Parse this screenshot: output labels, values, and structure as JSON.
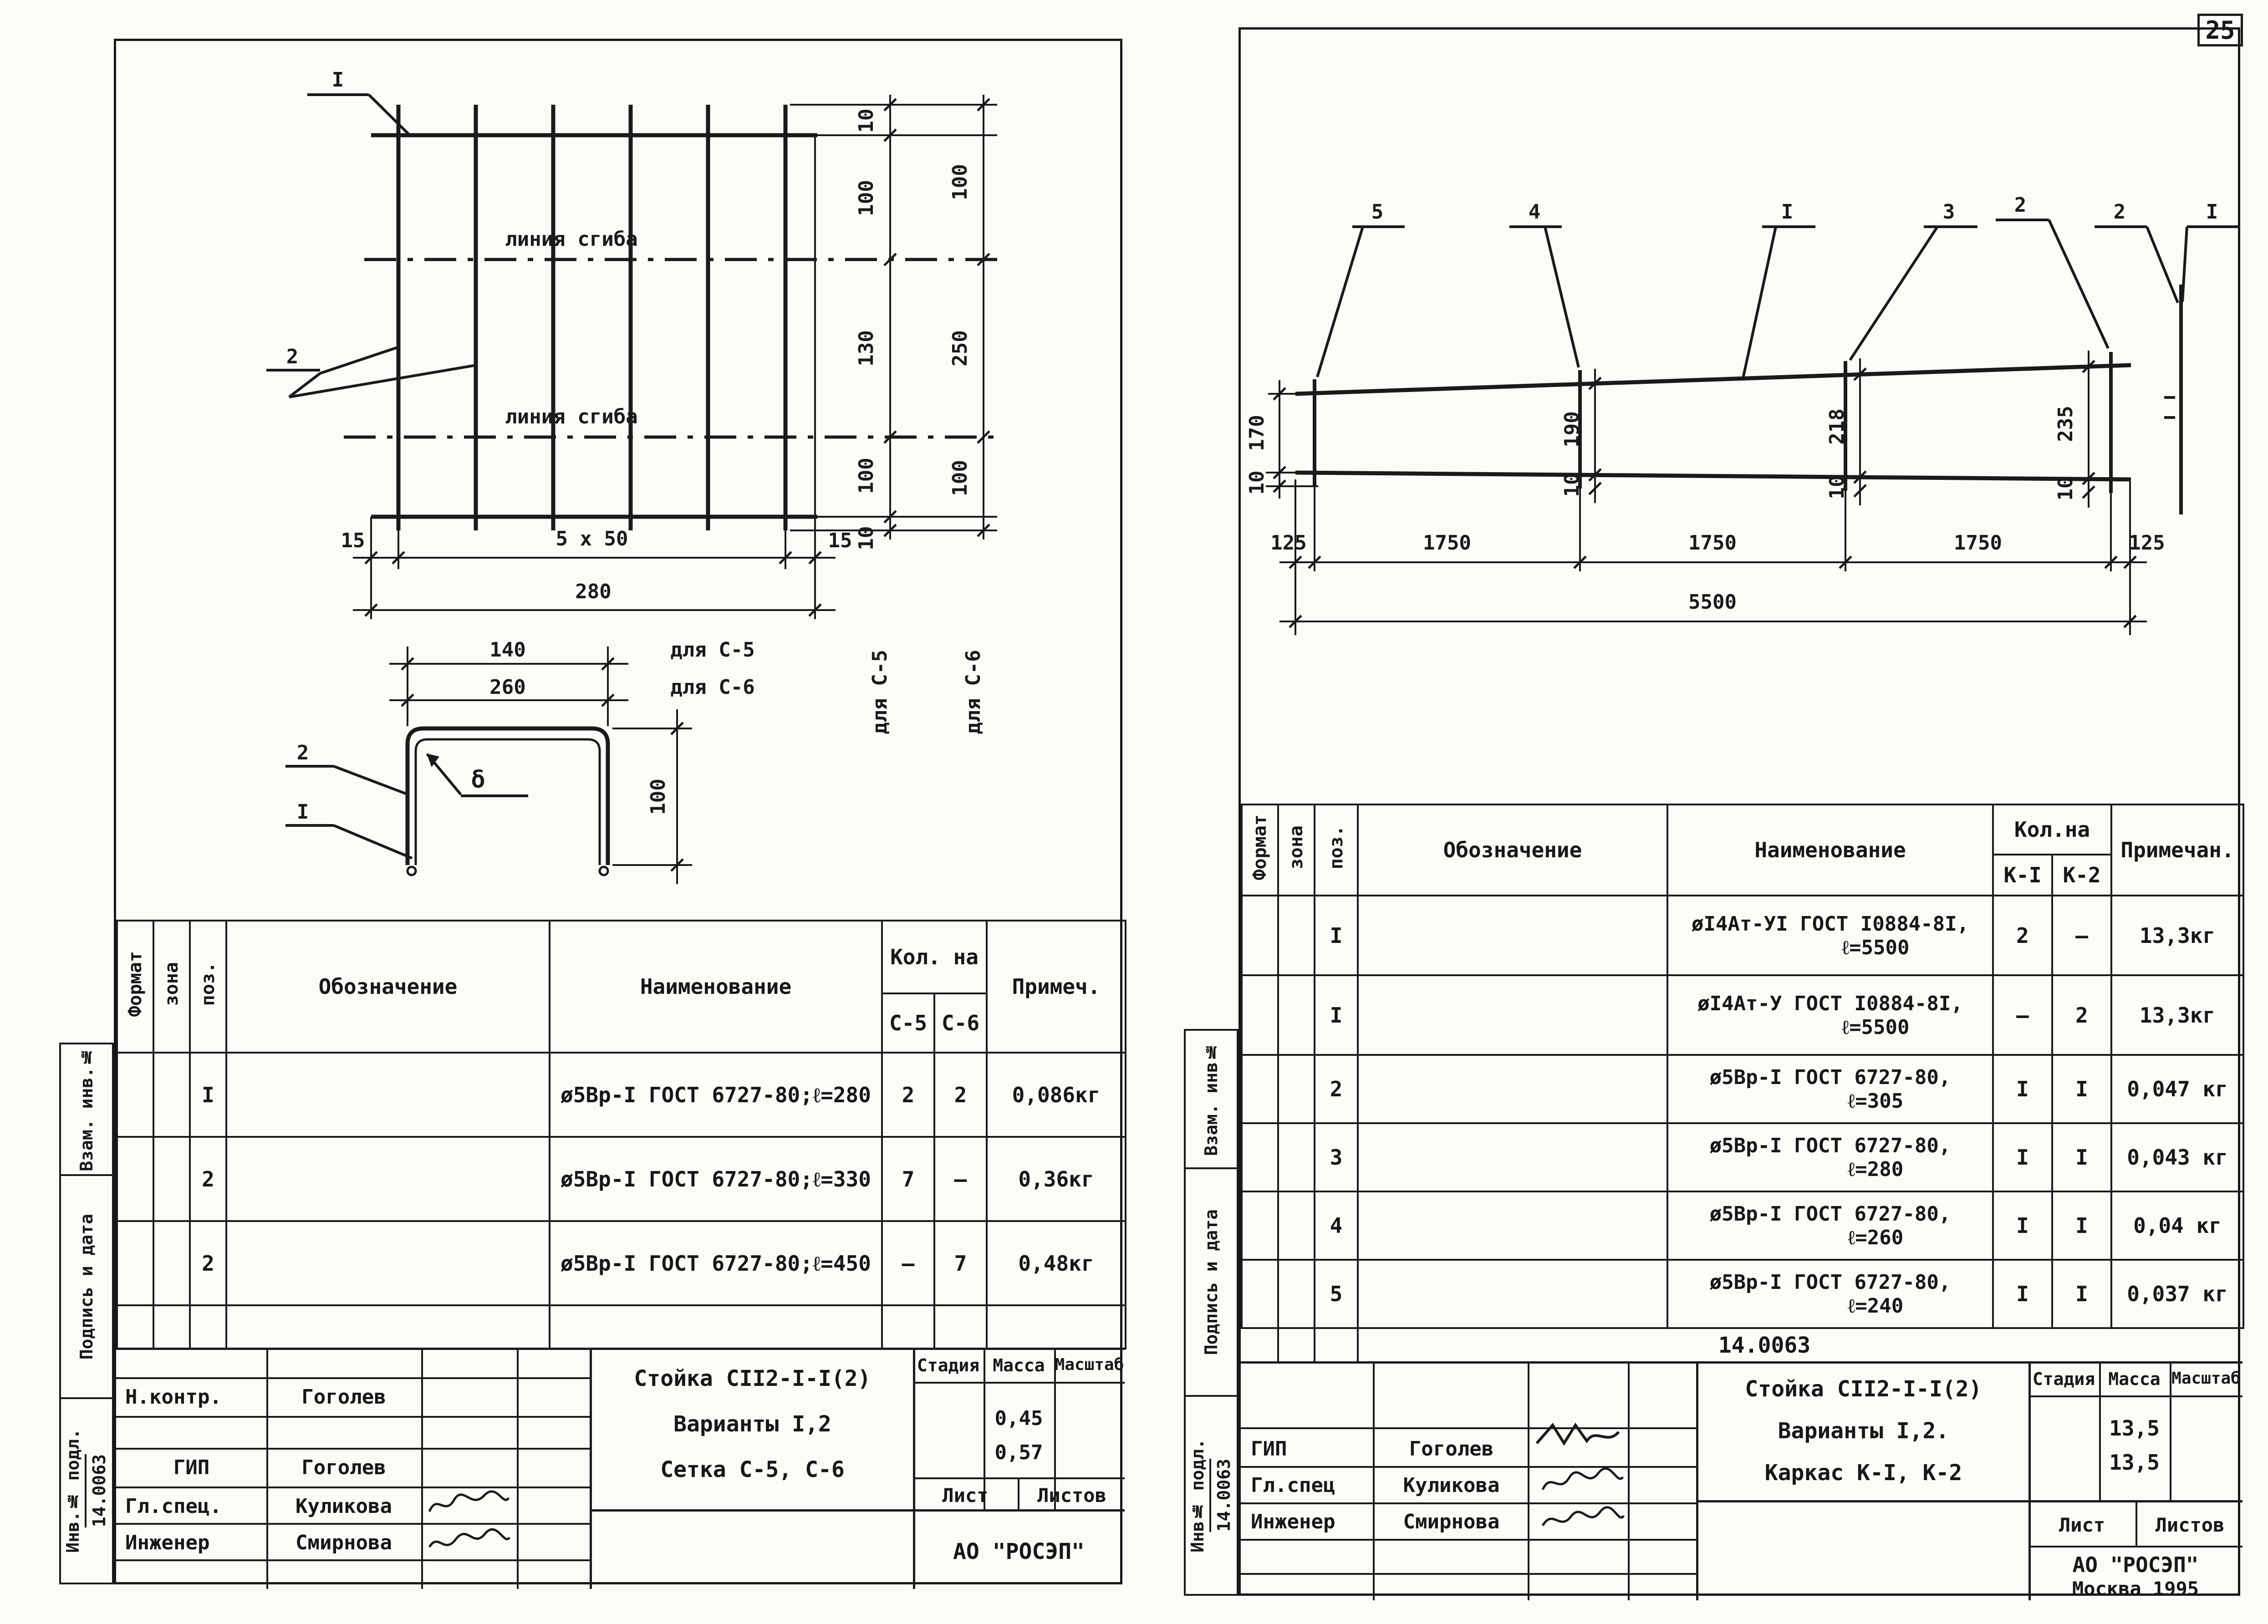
{
  "page_number": "25",
  "left_sheet": {
    "margin": {
      "vzam": "Взам. инв.№",
      "podpis": "Подпись и дата",
      "inv": "Инв.№ подл.",
      "doc": "14.0063"
    },
    "drawing": {
      "callout_1": "I",
      "callout_2": "2",
      "fold_label_1": "линия сгиба",
      "fold_label_2": "линия сгиба",
      "c5_chain": [
        "10",
        "100",
        "130",
        "100",
        "10"
      ],
      "c6_chain": [
        "100",
        "250",
        "100"
      ],
      "for_c5": "для С-5",
      "for_c6": "для С-6",
      "bottom_dims": [
        "15",
        "5 x 50",
        "15"
      ],
      "total_width": "280",
      "profile": {
        "callout_2": "2",
        "callout_1": "I",
        "thickness": "δ",
        "width_c5": "140",
        "width_c5_for": "для С-5",
        "width_c6": "260",
        "width_c6_for": "для С-6",
        "height": "100"
      }
    },
    "table": {
      "format": "Формат",
      "zone": "зона",
      "pos": "поз.",
      "designation": "Обозначение",
      "name": "Наименование",
      "qty": "Кол. на",
      "c5": "С-5",
      "c6": "С-6",
      "note": "Примеч.",
      "rows": [
        {
          "pos": "I",
          "name": "ø5Вр-I ГОСТ 6727-80;ℓ=280",
          "c5": "2",
          "c6": "2",
          "note": "0,086кг"
        },
        {
          "pos": "2",
          "name": "ø5Вр-I ГОСТ 6727-80;ℓ=330",
          "c5": "7",
          "c6": "–",
          "note": "0,36кг"
        },
        {
          "pos": "2",
          "name": "ø5Вр-I ГОСТ 6727-80;ℓ=450",
          "c5": "–",
          "c6": "7",
          "note": "0,48кг"
        }
      ]
    },
    "title_block": {
      "nkontr_role": "Н.контр.",
      "nkontr_name": "Гоголев",
      "gip_role": "ГИП",
      "gip_name": "Гоголев",
      "glspec_role": "Гл.спец.",
      "glspec_name": "Куликова",
      "engineer_role": "Инженер",
      "engineer_name": "Смирнова",
      "title_line1": "Стойка СII2-I-I(2)",
      "title_line2": "Варианты I,2",
      "title_line3": "Сетка С-5, С-6",
      "stage": "Стадия",
      "mass": "Масса",
      "scale": "Масштаб",
      "mass_1": "0,45",
      "mass_2": "0,57",
      "sheet": "Лист",
      "sheets": "Листов",
      "org": "АО \"РОСЭП\""
    }
  },
  "right_sheet": {
    "margin": {
      "vzam": "Взам. инв№",
      "podpis": "Подпись и дата",
      "inv": "Инв№ подл.",
      "doc": "14.0063"
    },
    "doc_number": "14.0063",
    "drawing": {
      "callouts": [
        "5",
        "4",
        "I",
        "3",
        "2"
      ],
      "detail_callouts": [
        "2",
        "I"
      ],
      "left_height": "170",
      "left_offset": "10",
      "mid_dims": [
        {
          "h": "190",
          "p": "10"
        },
        {
          "h": "218",
          "p": "10"
        },
        {
          "h": "235",
          "p": "10"
        }
      ],
      "bottom_dims": [
        "125",
        "1750",
        "1750",
        "1750",
        "125"
      ],
      "total_length": "5500"
    },
    "table": {
      "format": "Формат",
      "zone": "зона",
      "pos": "поз.",
      "designation": "Обозначение",
      "name": "Наименование",
      "qty": "Кол.на",
      "k1": "К-I",
      "k2": "К-2",
      "note": "Примечан.",
      "rows": [
        {
          "pos": "I",
          "n1": "øI4Ат-УI ГОСТ I0884-8I,",
          "n2": "ℓ=5500",
          "k1": "2",
          "k2": "–",
          "note": "13,3кг"
        },
        {
          "pos": "I",
          "n1": "øI4Ат-У ГОСТ I0884-8I,",
          "n2": "ℓ=5500",
          "k1": "–",
          "k2": "2",
          "note": "13,3кг"
        },
        {
          "pos": "2",
          "n1": "ø5Вр-I ГОСТ 6727-80,",
          "n2": "ℓ=305",
          "k1": "I",
          "k2": "I",
          "note": "0,047 кг"
        },
        {
          "pos": "3",
          "n1": "ø5Вр-I ГОСТ 6727-80,",
          "n2": "ℓ=280",
          "k1": "I",
          "k2": "I",
          "note": "0,043 кг"
        },
        {
          "pos": "4",
          "n1": "ø5Вр-I ГОСТ 6727-80,",
          "n2": "ℓ=260",
          "k1": "I",
          "k2": "I",
          "note": "0,04  кг"
        },
        {
          "pos": "5",
          "n1": "ø5Вр-I ГОСТ 6727-80,",
          "n2": "ℓ=240",
          "k1": "I",
          "k2": "I",
          "note": "0,037 кг"
        }
      ]
    },
    "title_block": {
      "gip_role": "ГИП",
      "gip_name": "Гоголев",
      "glspec_role": "Гл.спец",
      "glspec_name": "Куликова",
      "engineer_role": "Инженер",
      "engineer_name": "Смирнова",
      "title_line1": "Стойка СII2-I-I(2)",
      "title_line2": "Варианты I,2.",
      "title_line3": "Каркас К-I, К-2",
      "stage": "Стадия",
      "mass": "Масса",
      "scale": "Масштаб",
      "mass_1": "13,5",
      "mass_2": "13,5",
      "sheet": "Лист",
      "sheets": "Листов",
      "org": "АО \"РОСЭП\"",
      "city_year": "Москва  1995"
    }
  }
}
